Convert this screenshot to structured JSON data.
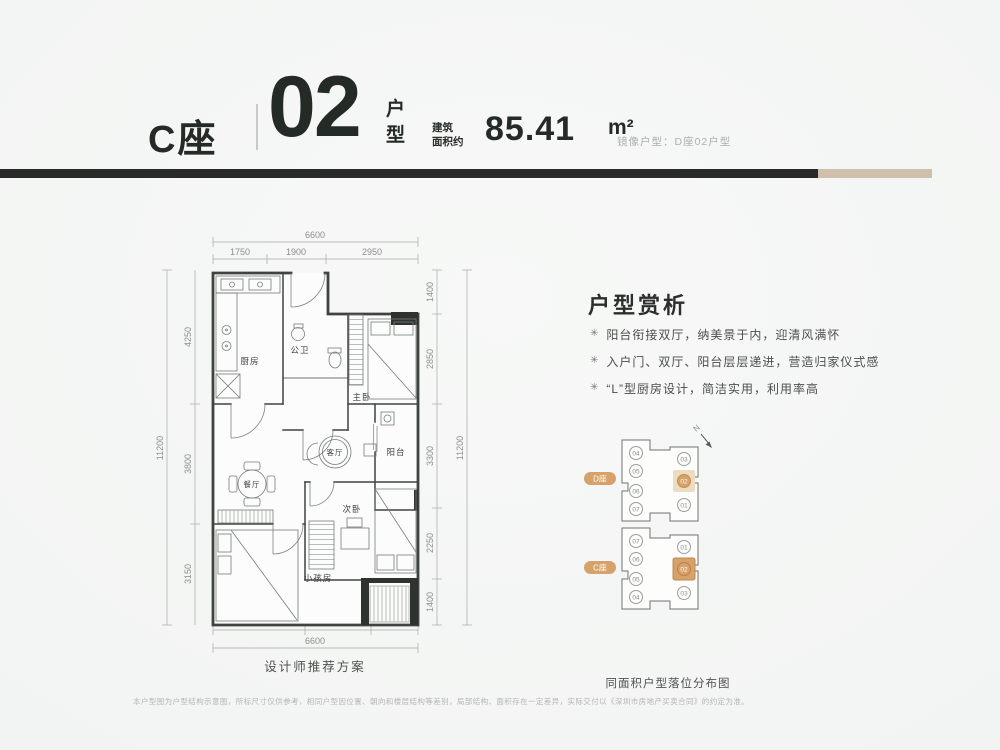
{
  "header": {
    "building": "C座",
    "unit_number": "02",
    "unit_suffix": "户型",
    "area_label_line1": "建筑",
    "area_label_line2": "面积约",
    "area_value": "85.41",
    "area_unit": "m²",
    "mirror_note": "镜像户型：D座02户型"
  },
  "plan": {
    "caption": "设计师推荐方案",
    "rooms": {
      "kitchen": "厨房",
      "bath": "公卫",
      "master": "主卧",
      "living": "客厅",
      "balcony": "阳台",
      "dining": "餐厅",
      "second_bedroom": "次卧",
      "kids_room": "小孩房"
    },
    "dims": {
      "top_total": "6600",
      "top": [
        "1750",
        "1900",
        "2950"
      ],
      "left_total": "11200",
      "left": [
        "4250",
        "3800",
        "3150"
      ],
      "right": [
        "1400",
        "2850",
        "3300",
        "2250",
        "1400"
      ],
      "right_total": "11200",
      "bottom": [
        "2950",
        "2150",
        "1500"
      ],
      "bottom_total": "6600"
    }
  },
  "analysis": {
    "title": "户型赏析",
    "bullet_glyph": "✳",
    "bullets": [
      "阳台衔接双厅，纳美景于内，迎清风满怀",
      "入户门、双厅、阳台层层递进，营造归家仪式感",
      "“L”型厨房设计，简洁实用，利用率高"
    ]
  },
  "locator": {
    "north_label": "N",
    "building_d_label": "D座",
    "building_c_label": "C座",
    "d_units_left": [
      "04",
      "05",
      "06",
      "07"
    ],
    "d_units_right": [
      "03",
      "02",
      "01"
    ],
    "c_units_left": [
      "07",
      "06",
      "05",
      "04"
    ],
    "c_units_right": [
      "01",
      "02",
      "03"
    ],
    "caption": "同面积户型落位分布图"
  },
  "disclaimer": "本户型图为户型结构示意图，所标尺寸仅供参考，相同户型因位置、朝向和楼层结构等差别，局部结构、面积存在一定差异，实际交付以《深圳市房地产买卖合同》的约定为准。",
  "colors": {
    "accent_dark": "#272c28",
    "accent_tan": "#cfc0ab",
    "highlight_tan": "#d7a269"
  }
}
